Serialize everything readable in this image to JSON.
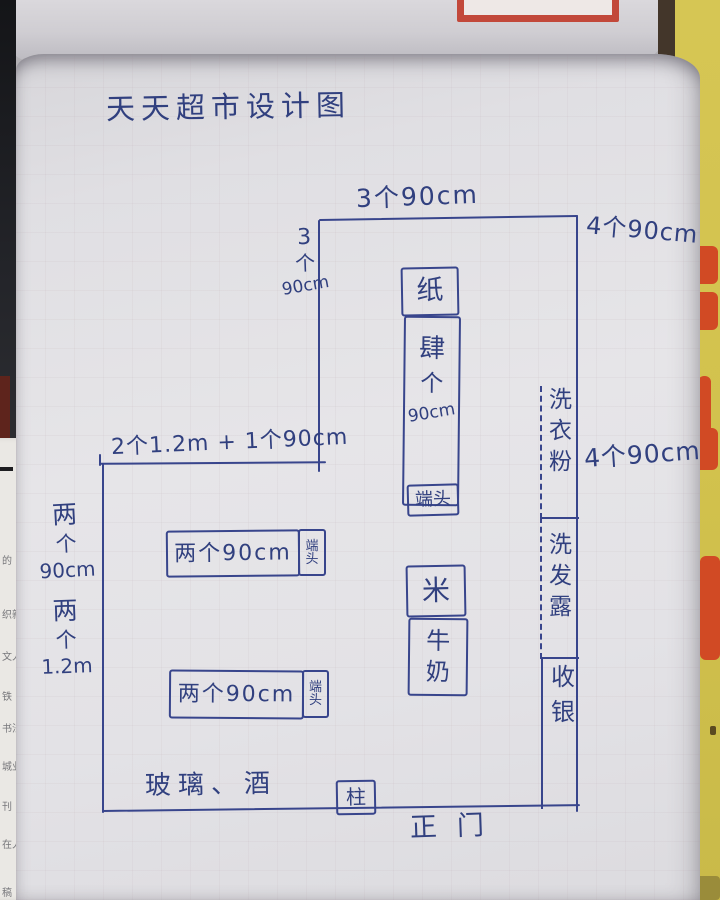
{
  "title": "天天超市设计图",
  "dims": {
    "top": "3个90cm",
    "top_left": [
      "3",
      "个",
      "90cm"
    ],
    "right_upper": "4个90cm",
    "right_lower": "4个90cm",
    "middle": "2个1.2m + 1个90cm",
    "left_upper": [
      "两",
      "个",
      "90cm"
    ],
    "left_lower": [
      "两",
      "个",
      "1.2m"
    ]
  },
  "fixtures": {
    "paper": "纸",
    "center_shelf": [
      "肆",
      "个",
      "90cm"
    ],
    "center_endcap": "端头",
    "shelf_a": "两个90cm",
    "shelf_a_endcap": [
      "端",
      "头"
    ],
    "shelf_b": "两个90cm",
    "shelf_b_endcap": [
      "端",
      "头"
    ],
    "rice": "米",
    "milk": [
      "牛",
      "奶"
    ],
    "laundry": [
      "洗",
      "衣",
      "粉"
    ],
    "shampoo": [
      "洗",
      "发",
      "露"
    ],
    "cashier": [
      "收",
      "银"
    ],
    "glass_wine": "玻璃、酒",
    "pillar": "柱",
    "entrance": "正门"
  },
  "background": {
    "left_paper_fragments": [
      "的",
      "织新",
      "文人",
      "铁",
      "书法",
      "城业",
      "刊",
      "在人",
      "稿"
    ],
    "colors": {
      "ink": "#38458c",
      "page": "#e4e3e6",
      "poster_yellow": "#d2c24d",
      "poster_red": "#d14a24",
      "frame_red": "#c2483a",
      "dark_strip": "#232429"
    }
  }
}
